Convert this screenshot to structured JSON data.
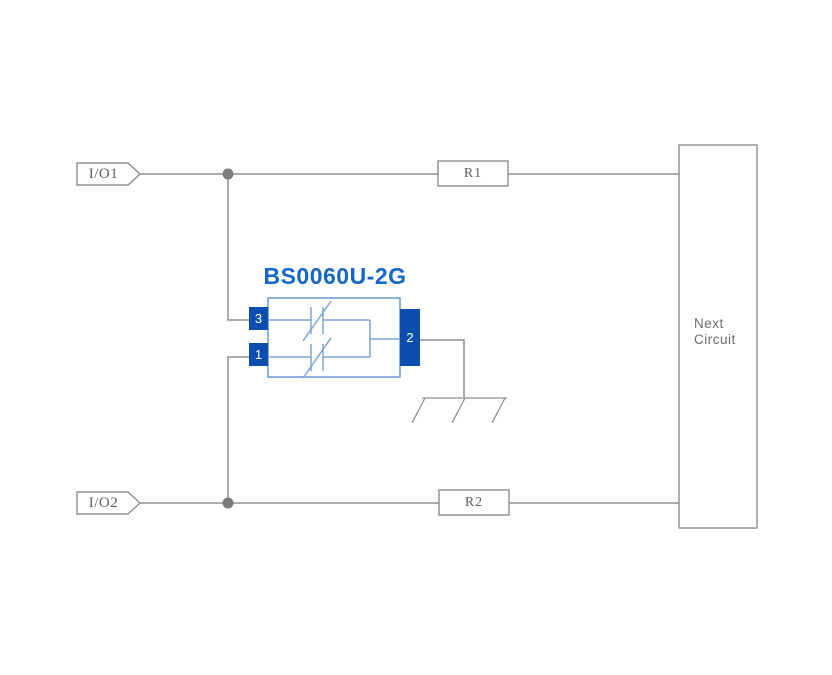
{
  "diagram": {
    "component": {
      "title": "BS0060U-2G",
      "pins": {
        "left_top": "3",
        "left_bottom": "1",
        "right": "2"
      }
    },
    "inputs": {
      "io1": "I/O1",
      "io2": "I/O2"
    },
    "resistors": {
      "r1": "R1",
      "r2": "R2"
    },
    "next_circuit": {
      "line1": "Next",
      "line2": "Circuit"
    },
    "icons": {
      "ground": "chassis-ground-icon",
      "junction": "junction-dot",
      "suppressor": "bidirectional-suppressor-icon",
      "io_tag": "signal-tag-pentagon"
    },
    "colors": {
      "title_blue": "#1467c8",
      "pin_blue": "#0c4eb0",
      "symbol_blue": "#7aa3d8",
      "wire_gray": "#8f8f8f",
      "dot_gray": "#7a7a7a",
      "label_gray": "#5f5f5f",
      "next_gray": "#6b6b6b"
    }
  }
}
